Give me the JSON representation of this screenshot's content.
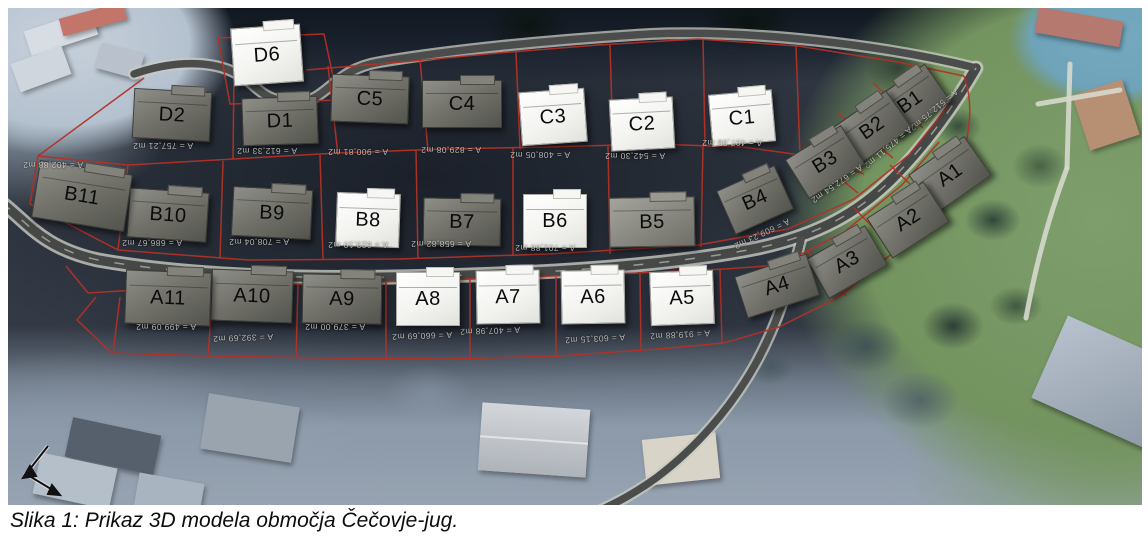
{
  "figure": {
    "caption": "Slika 1: Prikaz 3D modela območja Čečovje-jug."
  },
  "colors": {
    "highlighted_house": "#f3f3f0",
    "standard_house": "#73736c",
    "parcel_boundary": "#b23127",
    "road": "#454846",
    "grass": "#73935f",
    "water": "#6fa3ba"
  },
  "map": {
    "plots": [
      {
        "label": "D6",
        "type": "white",
        "x": 259,
        "y": 47,
        "w": 68,
        "h": 56,
        "rot": -4,
        "area": ""
      },
      {
        "label": "D2",
        "type": "gray",
        "x": 164,
        "y": 107,
        "w": 76,
        "h": 48,
        "rot": 3,
        "area": "A = 757,21 m2",
        "adx": -9,
        "ady": 31,
        "arot": 180
      },
      {
        "label": "D1",
        "type": "gray",
        "x": 272,
        "y": 113,
        "w": 74,
        "h": 46,
        "rot": -2,
        "area": "A = 612,33 m2",
        "adx": -13,
        "ady": 30,
        "arot": 180
      },
      {
        "label": "C5",
        "type": "gray",
        "x": 362,
        "y": 91,
        "w": 76,
        "h": 46,
        "rot": 2,
        "area": "A = 900,81 m2",
        "adx": -12,
        "ady": 53,
        "arot": 180
      },
      {
        "label": "C4",
        "type": "gray",
        "x": 454,
        "y": 96,
        "w": 78,
        "h": 46,
        "rot": 0,
        "area": "A = 829,08 m2",
        "adx": -11,
        "ady": 46,
        "arot": 180
      },
      {
        "label": "C3",
        "type": "white",
        "x": 545,
        "y": 109,
        "w": 64,
        "h": 52,
        "rot": -4,
        "area": "A = 408,05 m2",
        "adx": -13,
        "ady": 38,
        "arot": 180
      },
      {
        "label": "C2",
        "type": "white",
        "x": 634,
        "y": 116,
        "w": 62,
        "h": 50,
        "rot": -3,
        "area": "A = 542,30 m2",
        "adx": -7,
        "ady": 32,
        "arot": 180
      },
      {
        "label": "C1",
        "type": "white",
        "x": 734,
        "y": 110,
        "w": 62,
        "h": 50,
        "rot": -5,
        "area": "A = 497,98 m2",
        "adx": -10,
        "ady": 25,
        "arot": 180
      },
      {
        "label": "B1",
        "type": "gray",
        "x": 902,
        "y": 94,
        "w": 66,
        "h": 44,
        "rot": -35,
        "area": "A = 512,75 m2",
        "adx": 24,
        "ady": 8,
        "arot": 140
      },
      {
        "label": "B2",
        "type": "gray",
        "x": 864,
        "y": 120,
        "w": 64,
        "h": 44,
        "rot": -35,
        "area": "A = 475,11 m2",
        "adx": 16,
        "ady": 20,
        "arot": 140
      },
      {
        "label": "B3",
        "type": "gray",
        "x": 817,
        "y": 154,
        "w": 64,
        "h": 44,
        "rot": -32,
        "area": "A = 672,54 m2",
        "adx": 12,
        "ady": 22,
        "arot": 145
      },
      {
        "label": "B4",
        "type": "gray",
        "x": 747,
        "y": 192,
        "w": 62,
        "h": 46,
        "rot": -24,
        "area": "A = 609,23 m2",
        "adx": 7,
        "ady": 34,
        "arot": 155
      },
      {
        "label": "B5",
        "type": "gray-light",
        "x": 644,
        "y": 214,
        "w": 84,
        "h": 48,
        "rot": -1,
        "area": ""
      },
      {
        "label": "B6",
        "type": "white",
        "x": 547,
        "y": 213,
        "w": 62,
        "h": 52,
        "rot": 0,
        "area": "A = 701,88 m2",
        "adx": -10,
        "ady": 27,
        "arot": 180
      },
      {
        "label": "B7",
        "type": "gray",
        "x": 454,
        "y": 214,
        "w": 76,
        "h": 46,
        "rot": 1,
        "area": "A = 658,82 m2",
        "adx": -21,
        "ady": 22,
        "arot": 180
      },
      {
        "label": "B8",
        "type": "white",
        "x": 360,
        "y": 212,
        "w": 62,
        "h": 52,
        "rot": 2,
        "area": "A = 623,10 m2",
        "adx": -10,
        "ady": 25,
        "arot": 180
      },
      {
        "label": "B9",
        "type": "gray",
        "x": 264,
        "y": 205,
        "w": 78,
        "h": 48,
        "rot": 3,
        "area": "A = 708,04 m2",
        "adx": -13,
        "ady": 29,
        "arot": 180
      },
      {
        "label": "B10",
        "type": "gray",
        "x": 160,
        "y": 207,
        "w": 78,
        "h": 48,
        "rot": 4,
        "area": "A = 686,67 m2",
        "adx": -16,
        "ady": 28,
        "arot": 180
      },
      {
        "label": "B11",
        "type": "gray",
        "x": 74,
        "y": 188,
        "w": 92,
        "h": 56,
        "rot": 9,
        "area": "A = 402,88 m2",
        "adx": -29,
        "ady": -31,
        "arot": 180
      },
      {
        "label": "A1",
        "type": "gray",
        "x": 942,
        "y": 167,
        "w": 66,
        "h": 46,
        "rot": -35,
        "area": ""
      },
      {
        "label": "A2",
        "type": "gray",
        "x": 900,
        "y": 212,
        "w": 66,
        "h": 46,
        "rot": -33,
        "area": ""
      },
      {
        "label": "A3",
        "type": "gray",
        "x": 839,
        "y": 254,
        "w": 66,
        "h": 44,
        "rot": -30,
        "area": ""
      },
      {
        "label": "A4",
        "type": "gray",
        "x": 769,
        "y": 278,
        "w": 74,
        "h": 42,
        "rot": -18,
        "area": ""
      },
      {
        "label": "A5",
        "type": "white",
        "x": 674,
        "y": 290,
        "w": 62,
        "h": 52,
        "rot": -2,
        "area": "A = 919,88 m2",
        "adx": -2,
        "ady": 37,
        "arot": 177
      },
      {
        "label": "A6",
        "type": "white",
        "x": 585,
        "y": 289,
        "w": 62,
        "h": 52,
        "rot": -1,
        "area": "A = 603,15 m2",
        "adx": 2,
        "ady": 42,
        "arot": 177
      },
      {
        "label": "A7",
        "type": "white",
        "x": 500,
        "y": 289,
        "w": 62,
        "h": 52,
        "rot": -1,
        "area": "A = 407,98 m2",
        "adx": -18,
        "ady": 34,
        "arot": 178
      },
      {
        "label": "A8",
        "type": "white",
        "x": 420,
        "y": 291,
        "w": 62,
        "h": 52,
        "rot": 0,
        "area": "A = 660,69 m2",
        "adx": -6,
        "ady": 37,
        "arot": 178
      },
      {
        "label": "A9",
        "type": "gray",
        "x": 334,
        "y": 291,
        "w": 78,
        "h": 48,
        "rot": 1,
        "area": "A = 379,00 m2",
        "adx": -7,
        "ady": 28,
        "arot": 180
      },
      {
        "label": "A10",
        "type": "gray",
        "x": 244,
        "y": 288,
        "w": 80,
        "h": 50,
        "rot": 2,
        "area": "A = 392,69 m2",
        "adx": -9,
        "ady": 42,
        "arot": 178
      },
      {
        "label": "A11",
        "type": "gray",
        "x": 160,
        "y": 290,
        "w": 84,
        "h": 52,
        "rot": 2,
        "area": "A = 499,09 m2",
        "adx": -2,
        "ady": 29,
        "arot": 180
      }
    ]
  }
}
